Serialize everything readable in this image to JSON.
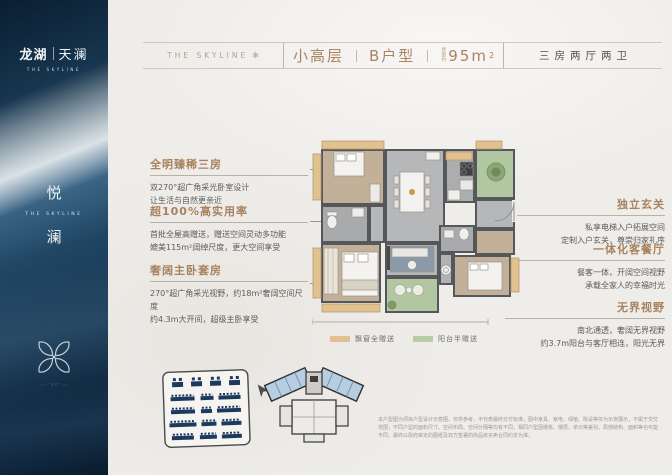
{
  "sidebar": {
    "brand_left": "龙湖",
    "brand_right": "天澜",
    "brand_en": "THE SKYLINE",
    "vertical_top": "悦",
    "vertical_en": "THE SKYLINE",
    "vertical_bottom": "澜"
  },
  "header": {
    "logo_text": "THE SKYLINE",
    "flourish": "✻",
    "floor_type": "小高层",
    "unit_type": "B户型",
    "area_prefix": "建面约",
    "area_value": "95m",
    "area_sup": "2",
    "layout_summary": "三房两厅两卫"
  },
  "left_features": [
    {
      "title": "全明臻稀三房",
      "line1": "双270°超广角采光卧室设计",
      "line2": "让生活与自然更亲近"
    },
    {
      "title": "超100%高实用率",
      "line1": "首批全屋高赠送，赠送空间灵动多功能",
      "line2": "媲美115m²阔绰尺度，更大空间享受"
    },
    {
      "title": "奢阔主卧套房",
      "line1": "270°超广角采光视野，约18m²奢阔空间尺度",
      "line2": "约4.3m大开间，超级主卧享受"
    }
  ],
  "right_features": [
    {
      "title": "独立玄关",
      "line1": "私享电梯入户拓展空间",
      "line2": "定制入户玄关，尊崇归家礼序"
    },
    {
      "title": "一体化客餐厅",
      "line1": "餐客一体，开阔空间视野",
      "line2": "承载全家人的幸福时光"
    },
    {
      "title": "无界视野",
      "line1": "南北通透，奢阔无界视野",
      "line2": "约3.7m阳台与客厅相连，阳光无界"
    }
  ],
  "legend": [
    {
      "label": "飘窗全赠送",
      "color": "#e0c18f"
    },
    {
      "label": "阳台半赠送",
      "color": "#b9cda4"
    }
  ],
  "disclaimer": "本户型图为项目户型设计示意图，仅供参考，不代表最终交付标准，图中家具、家电、绿植、陈设等仅为示意展示，不属于交付范围；不同户型的面积尺寸、空间布局、空间分隔等均有不同，相同户型因楼栋、楼层、单元等差别，局部结构、面积等也可能不同，最终以政府审定的图纸及双方签署的商品房买卖合同约定为准。",
  "colors": {
    "accent_tan": "#a8825e",
    "sidebar_navy": "#16324d",
    "bay_window_tan": "#e0c18f",
    "balcony_green": "#b9cda4",
    "site_building_navy": "#1d3a5e",
    "keyplan_highlight_blue": "#b7cde1"
  }
}
